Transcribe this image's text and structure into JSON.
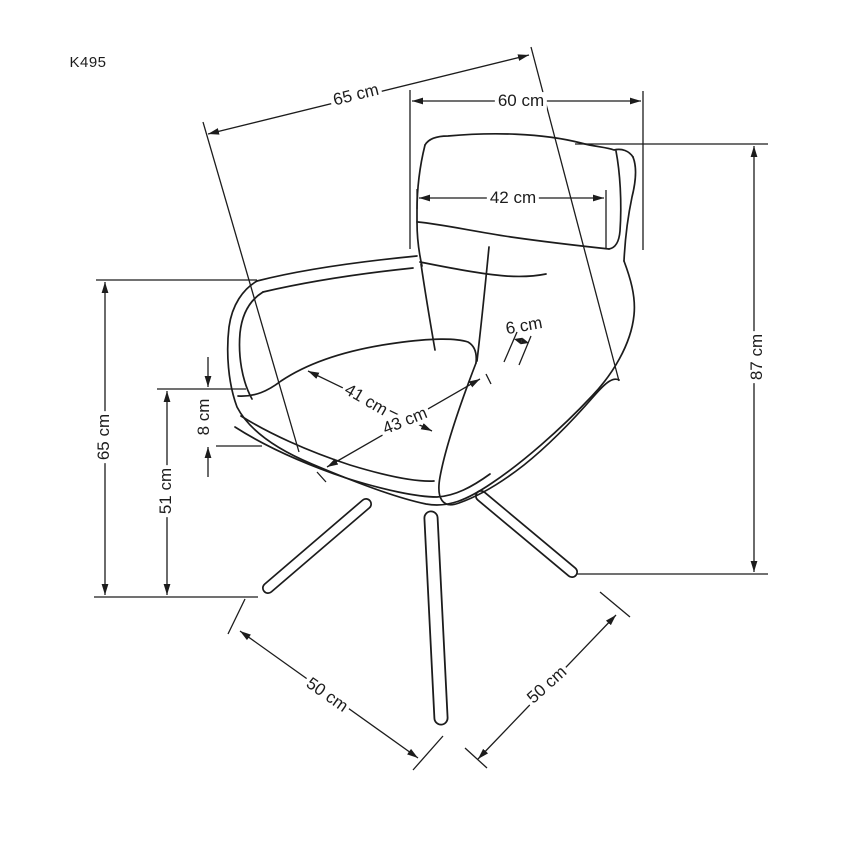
{
  "diagram": {
    "model_label": "K495",
    "unit": "cm",
    "figure": "armchair-technical-drawing",
    "line_color": "#1c1c1c",
    "background_color": "#ffffff",
    "dimensions": [
      {
        "name": "overall-depth-top",
        "label": "65 cm",
        "value": 65
      },
      {
        "name": "overall-width",
        "label": "60 cm",
        "value": 60
      },
      {
        "name": "backrest-cushion-width",
        "label": "42 cm",
        "value": 42
      },
      {
        "name": "armrest-thickness",
        "label": "6 cm",
        "value": 6
      },
      {
        "name": "seat-width",
        "label": "41 cm",
        "value": 41
      },
      {
        "name": "seat-depth",
        "label": "43 cm",
        "value": 43
      },
      {
        "name": "overall-height",
        "label": "87 cm",
        "value": 87
      },
      {
        "name": "armrest-height",
        "label": "65 cm",
        "value": 65
      },
      {
        "name": "seat-height",
        "label": "51 cm",
        "value": 51
      },
      {
        "name": "seat-edge-thickness",
        "label": "8 cm",
        "value": 8
      },
      {
        "name": "base-spread-left",
        "label": "50 cm",
        "value": 50
      },
      {
        "name": "base-spread-right",
        "label": "50 cm",
        "value": 50
      }
    ]
  }
}
